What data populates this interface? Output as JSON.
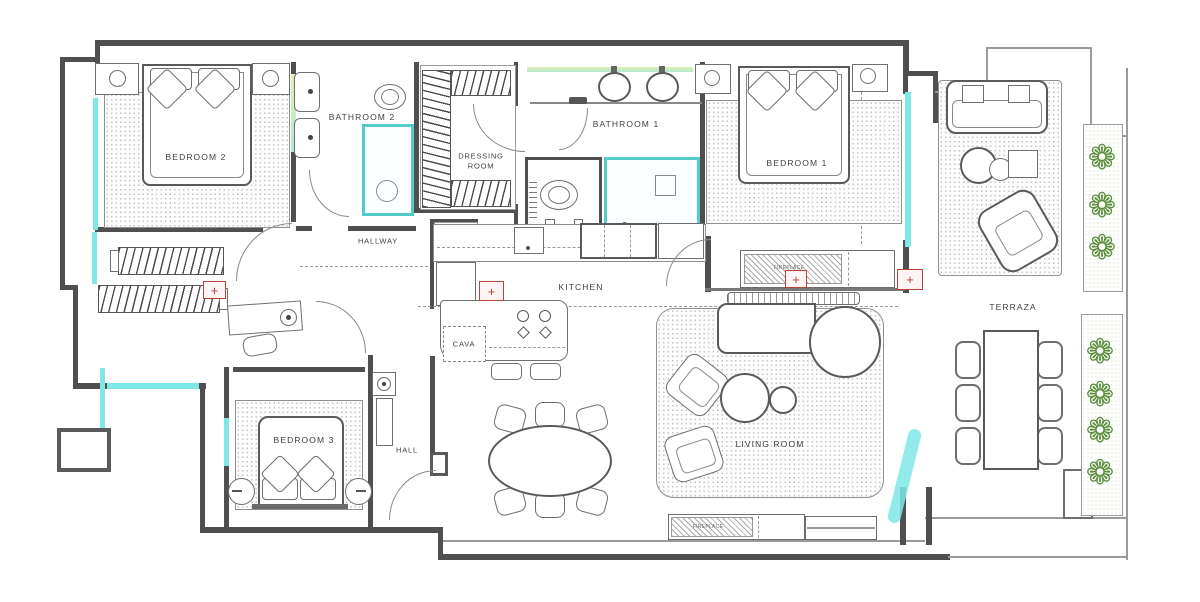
{
  "title": "Apartment floor plan",
  "labels": {
    "bedroom2": "BEDROOM 2",
    "bathroom2": "BATHROOM 2",
    "dressing_line1": "DRESSING",
    "dressing_line2": "ROOM",
    "bathroom1": "BATHROOM 1",
    "bedroom1": "BEDROOM 1",
    "hallway": "HALLWAY",
    "kitchen": "KITCHEN",
    "cava": "CAVA",
    "living_room": "LIVING ROOM",
    "bedroom3": "BEDROOM 3",
    "hall": "HALL",
    "terraza": "TERRAZA",
    "fireplace_top": "FIREPLACE",
    "fireplace_bottom": "FIREPLACE",
    "laundry_line1": "SEC",
    "laundry_line2": "LAV"
  },
  "symbols": {
    "outlet_plus": "+",
    "plant": "❁"
  },
  "colors": {
    "wall": "#4f4f4f",
    "drawing_line": "#6e6e6e",
    "window_cyan": "#7fe8e6",
    "window_green": "#dff0b2",
    "shower_teal": "#54cbc6",
    "outlet_red": "#b8453c",
    "plant_green": "#5b8f3e",
    "label_text": "#3f3f3f"
  }
}
